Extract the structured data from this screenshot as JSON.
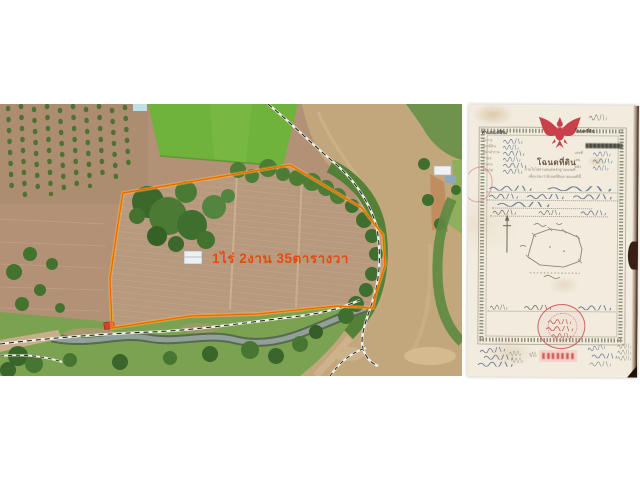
{
  "page": {
    "background": "#ffffff"
  },
  "listing": {
    "area_label": "1ไร่ 2งาน 35ตารางวา",
    "label_color": "#e8490f",
    "plot_outline_color": "#ff9300"
  },
  "deed": {
    "position_header": "ตำแหน่งที่ดิน",
    "left_fields": [
      "ระวาง",
      "เลขที่ดิน",
      "หน้าสำรวจ",
      "ตำบล",
      "อำเภอ",
      "จังหวัด"
    ],
    "deed_header": "โฉนดที่ดิน",
    "right_fields": [
      "เลขที่",
      "เล่ม",
      "หน้า"
    ],
    "title": "โฉนดที่ดิน",
    "subtitle_line1": "ด้วยใบไต่สวนหมุดหลักฐานแผนที่",
    "subtitle_line2": "เพื่อแสดงว่ามีเขตที่ดินตามแผนที่นี้",
    "garuda_color": "#c9404a",
    "seal_color": "#cd4248",
    "paper_color": "#f2ecdf"
  }
}
